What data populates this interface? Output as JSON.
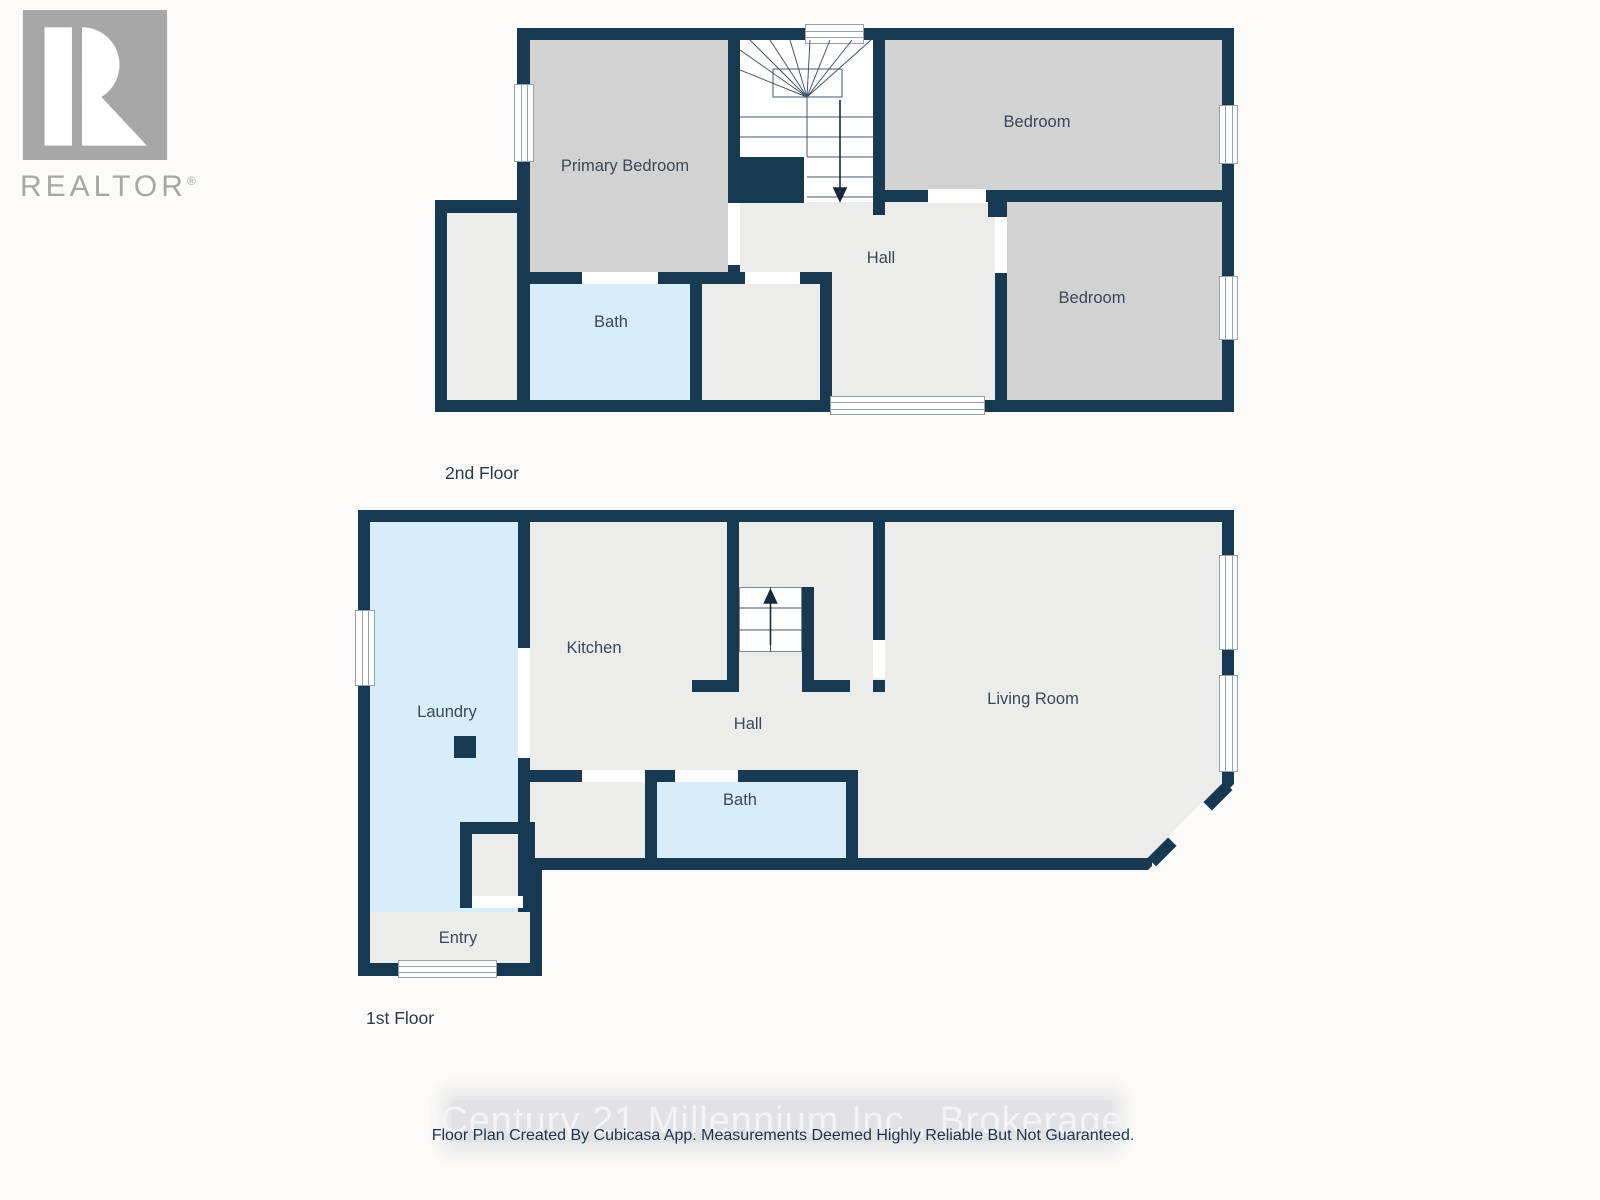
{
  "logo": {
    "name": "REALTOR",
    "reg": "®"
  },
  "floor2": {
    "title": "2nd Floor",
    "rooms": {
      "primary_bedroom": "Primary Bedroom",
      "bedroom_top": "Bedroom",
      "bedroom_bottom": "Bedroom",
      "hall": "Hall",
      "bath": "Bath"
    }
  },
  "floor1": {
    "title": "1st Floor",
    "rooms": {
      "laundry": "Laundry",
      "kitchen": "Kitchen",
      "hall": "Hall",
      "living_room": "Living Room",
      "bath": "Bath",
      "entry": "Entry"
    }
  },
  "footer": {
    "watermark": "Century 21 Millennium Inc., Brokerage",
    "disclaimer": "Floor Plan Created By Cubicasa App. Measurements Deemed Highly Reliable But Not Guaranteed."
  },
  "colors": {
    "wall": "#173a52",
    "room_gray": "#d2d2d2",
    "room_light": "#ececeb",
    "room_blue": "#d8edfa",
    "logo_gray": "#a7a7a7",
    "background": "#fcfbf9",
    "label_text": "#3b4856"
  }
}
